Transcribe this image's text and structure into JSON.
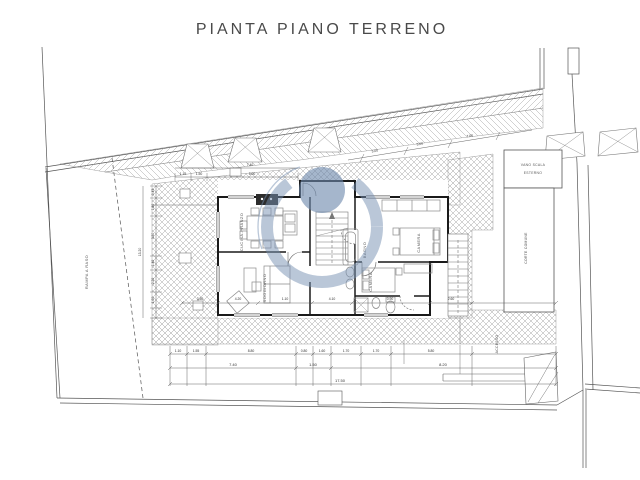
{
  "title": "PIANTA PIANO TERRENO",
  "plan": {
    "room_labels": {
      "kitchen": "CUCINA-PRANZO",
      "living": "SOGGIORNO",
      "bedroom1": "CAMERA",
      "bedroom2": "CAMERA",
      "bath": "BAGNO"
    },
    "annex": {
      "line1": "VANO SCALA",
      "line2": "ESTERNO",
      "side_label": "CORTE COMUNE"
    },
    "street_left": "RAMPA A RASO",
    "access_right": "ACCESSO"
  },
  "dimensions": {
    "bottom_row1": [
      "1.10",
      "1.55",
      "8.80",
      "0.80",
      "1.60",
      "1.70",
      "1.70",
      "5.80"
    ],
    "bottom_row2": [
      "7.40",
      "1.50",
      "8.20"
    ],
    "bottom_total": "17.50",
    "top_row": [
      "1.10",
      "1.50",
      "5.00"
    ],
    "top_total": "7.40",
    "slope": [
      "3.00",
      "5.00",
      "7.00"
    ],
    "left": [
      "0.45",
      "1.80",
      "3.30",
      "1.40",
      "2.20",
      "1.60"
    ],
    "left_total": "13.20",
    "mid": [
      "3.50",
      "4.20",
      "1.10",
      "4.10",
      "0.90",
      "2.60"
    ]
  },
  "watermark": {
    "ring_color": "#7590b2",
    "dot_color": "#6d89ad"
  }
}
